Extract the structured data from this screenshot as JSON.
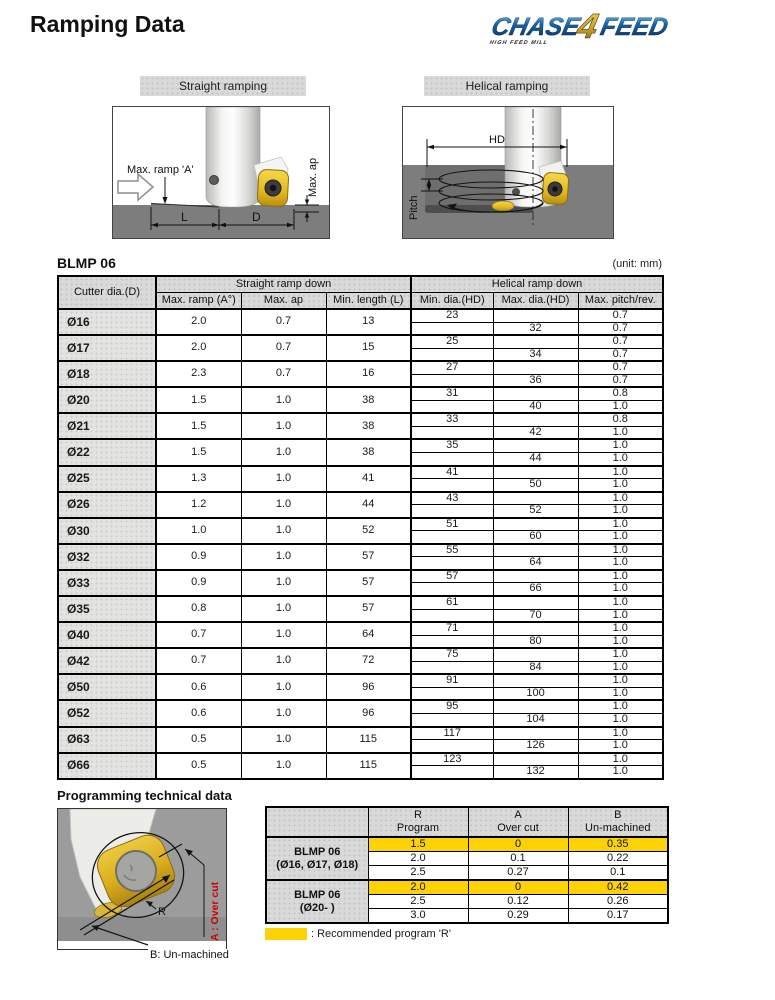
{
  "page": {
    "title": "Ramping Data",
    "unit_label": "(unit: mm)"
  },
  "logo": {
    "chase": "CHASE",
    "four": "4",
    "feed": "FEED",
    "tagline": "HIGH FEED MILL"
  },
  "colors": {
    "highlight_yellow": "#FCD205",
    "overcut_red": "#CC0000",
    "logo_navy": "#0D3B6E",
    "logo_gold": "#C9A227",
    "workpiece_gray": "#7D7D7D",
    "header_gray": "#D9D9D9"
  },
  "figures": {
    "straight": {
      "label": "Straight ramping",
      "ann": {
        "max_ramp": "Max. ramp 'A'",
        "max_ap": "Max. ap",
        "l": "L",
        "d": "D"
      }
    },
    "helical": {
      "label": "Helical ramping",
      "ann": {
        "hd": "HD",
        "pitch": "Pitch"
      }
    }
  },
  "main_table": {
    "title": "BLMP 06",
    "groups": {
      "cutter": "Cutter dia.(D)",
      "straight": "Straight ramp down",
      "helical": "Helical ramp down"
    },
    "columns": [
      "Max. ramp (A°)",
      "Max. ap",
      "Min. length (L)",
      "Min. dia.(HD)",
      "Max. dia.(HD)",
      "Max. pitch/rev."
    ],
    "rows": [
      {
        "dia": "Ø16",
        "max_ramp": "2.0",
        "max_ap": "0.7",
        "min_length": "13",
        "min_dia": "23",
        "max_dia": "32",
        "pitch_min": "0.7",
        "pitch_max": "0.7"
      },
      {
        "dia": "Ø17",
        "max_ramp": "2.0",
        "max_ap": "0.7",
        "min_length": "15",
        "min_dia": "25",
        "max_dia": "34",
        "pitch_min": "0.7",
        "pitch_max": "0.7"
      },
      {
        "dia": "Ø18",
        "max_ramp": "2.3",
        "max_ap": "0.7",
        "min_length": "16",
        "min_dia": "27",
        "max_dia": "36",
        "pitch_min": "0.7",
        "pitch_max": "0.7"
      },
      {
        "dia": "Ø20",
        "max_ramp": "1.5",
        "max_ap": "1.0",
        "min_length": "38",
        "min_dia": "31",
        "max_dia": "40",
        "pitch_min": "0.8",
        "pitch_max": "1.0"
      },
      {
        "dia": "Ø21",
        "max_ramp": "1.5",
        "max_ap": "1.0",
        "min_length": "38",
        "min_dia": "33",
        "max_dia": "42",
        "pitch_min": "0.8",
        "pitch_max": "1.0"
      },
      {
        "dia": "Ø22",
        "max_ramp": "1.5",
        "max_ap": "1.0",
        "min_length": "38",
        "min_dia": "35",
        "max_dia": "44",
        "pitch_min": "1.0",
        "pitch_max": "1.0"
      },
      {
        "dia": "Ø25",
        "max_ramp": "1.3",
        "max_ap": "1.0",
        "min_length": "41",
        "min_dia": "41",
        "max_dia": "50",
        "pitch_min": "1.0",
        "pitch_max": "1.0"
      },
      {
        "dia": "Ø26",
        "max_ramp": "1.2",
        "max_ap": "1.0",
        "min_length": "44",
        "min_dia": "43",
        "max_dia": "52",
        "pitch_min": "1.0",
        "pitch_max": "1.0"
      },
      {
        "dia": "Ø30",
        "max_ramp": "1.0",
        "max_ap": "1.0",
        "min_length": "52",
        "min_dia": "51",
        "max_dia": "60",
        "pitch_min": "1.0",
        "pitch_max": "1.0"
      },
      {
        "dia": "Ø32",
        "max_ramp": "0.9",
        "max_ap": "1.0",
        "min_length": "57",
        "min_dia": "55",
        "max_dia": "64",
        "pitch_min": "1.0",
        "pitch_max": "1.0"
      },
      {
        "dia": "Ø33",
        "max_ramp": "0.9",
        "max_ap": "1.0",
        "min_length": "57",
        "min_dia": "57",
        "max_dia": "66",
        "pitch_min": "1.0",
        "pitch_max": "1.0"
      },
      {
        "dia": "Ø35",
        "max_ramp": "0.8",
        "max_ap": "1.0",
        "min_length": "57",
        "min_dia": "61",
        "max_dia": "70",
        "pitch_min": "1.0",
        "pitch_max": "1.0"
      },
      {
        "dia": "Ø40",
        "max_ramp": "0.7",
        "max_ap": "1.0",
        "min_length": "64",
        "min_dia": "71",
        "max_dia": "80",
        "pitch_min": "1.0",
        "pitch_max": "1.0"
      },
      {
        "dia": "Ø42",
        "max_ramp": "0.7",
        "max_ap": "1.0",
        "min_length": "72",
        "min_dia": "75",
        "max_dia": "84",
        "pitch_min": "1.0",
        "pitch_max": "1.0"
      },
      {
        "dia": "Ø50",
        "max_ramp": "0.6",
        "max_ap": "1.0",
        "min_length": "96",
        "min_dia": "91",
        "max_dia": "100",
        "pitch_min": "1.0",
        "pitch_max": "1.0"
      },
      {
        "dia": "Ø52",
        "max_ramp": "0.6",
        "max_ap": "1.0",
        "min_length": "96",
        "min_dia": "95",
        "max_dia": "104",
        "pitch_min": "1.0",
        "pitch_max": "1.0"
      },
      {
        "dia": "Ø63",
        "max_ramp": "0.5",
        "max_ap": "1.0",
        "min_length": "115",
        "min_dia": "117",
        "max_dia": "126",
        "pitch_min": "1.0",
        "pitch_max": "1.0"
      },
      {
        "dia": "Ø66",
        "max_ramp": "0.5",
        "max_ap": "1.0",
        "min_length": "115",
        "min_dia": "123",
        "max_dia": "132",
        "pitch_min": "1.0",
        "pitch_max": "1.0"
      }
    ]
  },
  "programming": {
    "heading": "Programming technical data",
    "image_labels": {
      "r": "R",
      "a": "A : Over cut",
      "b": "B: Un-machined"
    },
    "table": {
      "columns": [
        [
          "R",
          "Program"
        ],
        [
          "A",
          "Over cut"
        ],
        [
          "B",
          "Un-machined"
        ]
      ],
      "groups": [
        {
          "label_line1": "BLMP 06",
          "label_line2": "(Ø16, Ø17, Ø18)",
          "rows": [
            {
              "r": "1.5",
              "a": "0",
              "b": "0.35",
              "highlight": true
            },
            {
              "r": "2.0",
              "a": "0.1",
              "b": "0.22",
              "highlight": false
            },
            {
              "r": "2.5",
              "a": "0.27",
              "b": "0.1",
              "highlight": false
            }
          ]
        },
        {
          "label_line1": "BLMP 06",
          "label_line2": "(Ø20- )",
          "rows": [
            {
              "r": "2.0",
              "a": "0",
              "b": "0.42",
              "highlight": true
            },
            {
              "r": "2.5",
              "a": "0.12",
              "b": "0.26",
              "highlight": false
            },
            {
              "r": "3.0",
              "a": "0.29",
              "b": "0.17",
              "highlight": false
            }
          ]
        }
      ]
    },
    "legend": ": Recommended program 'R'"
  }
}
